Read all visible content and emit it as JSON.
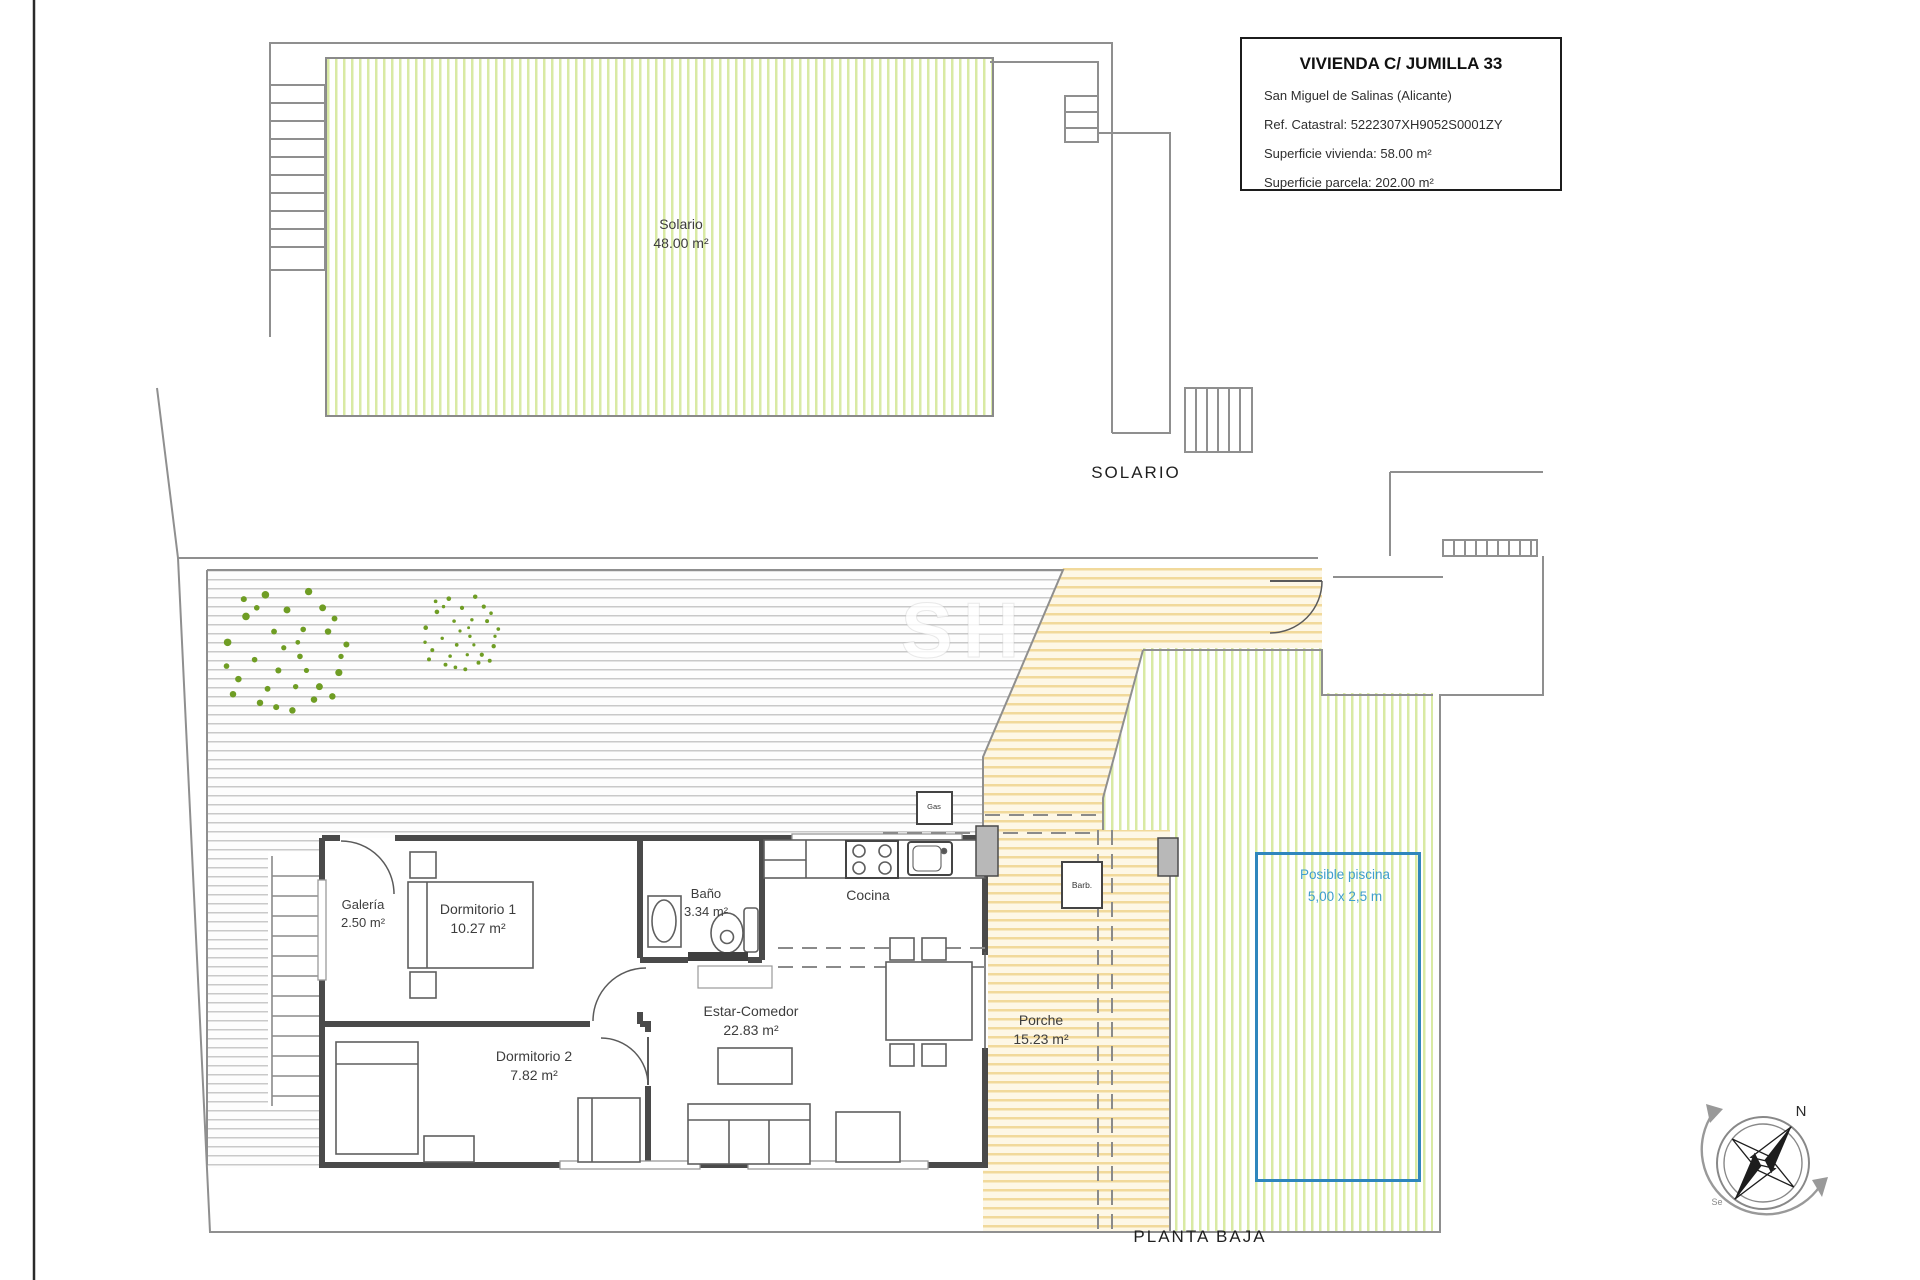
{
  "title_block": {
    "title": "VIVIENDA C/ JUMILLA 33",
    "location": "San Miguel de Salinas (Alicante)",
    "cadastral": "Ref. Catastral: 5222307XH9052S0001ZY",
    "dwelling_area": "Superficie vivienda: 58.00 m²",
    "plot_area": "Superficie parcela: 202.00 m²"
  },
  "plans": {
    "upper": {
      "caption": "SOLARIO",
      "room": "Solario",
      "area": "48.00 m²"
    },
    "lower": {
      "caption": "PLANTA BAJA"
    }
  },
  "rooms": [
    {
      "name": "Galería",
      "area": "2.50 m²"
    },
    {
      "name": "Dormitorio 1",
      "area": "10.27 m²"
    },
    {
      "name": "Baño",
      "area": "3.34 m²"
    },
    {
      "name": "Cocina",
      "area": ""
    },
    {
      "name": "Estar-Comedor",
      "area": "22.83 m²"
    },
    {
      "name": "Dormitorio 2",
      "area": "7.82 m²"
    },
    {
      "name": "Porche",
      "area": "15.23 m²"
    }
  ],
  "pool": {
    "label": "Posible piscina",
    "size": "5,00 x 2,5 m"
  },
  "annotations": {
    "gas": "Gas",
    "barbecue": "Barb.",
    "north": "N",
    "southeast": "Se",
    "watermark": "SH"
  },
  "colors": {
    "hatch_green": "#d9eaa4",
    "hatch_yellow": "#f1d99b",
    "deck_line": "#c9c9c9",
    "pool_blue": "#2f86bd",
    "pool_text": "#3f9ecd",
    "tree_green": "#6f9d24",
    "wall": "#4a4a4a",
    "boundary": "#8f8f8f"
  }
}
